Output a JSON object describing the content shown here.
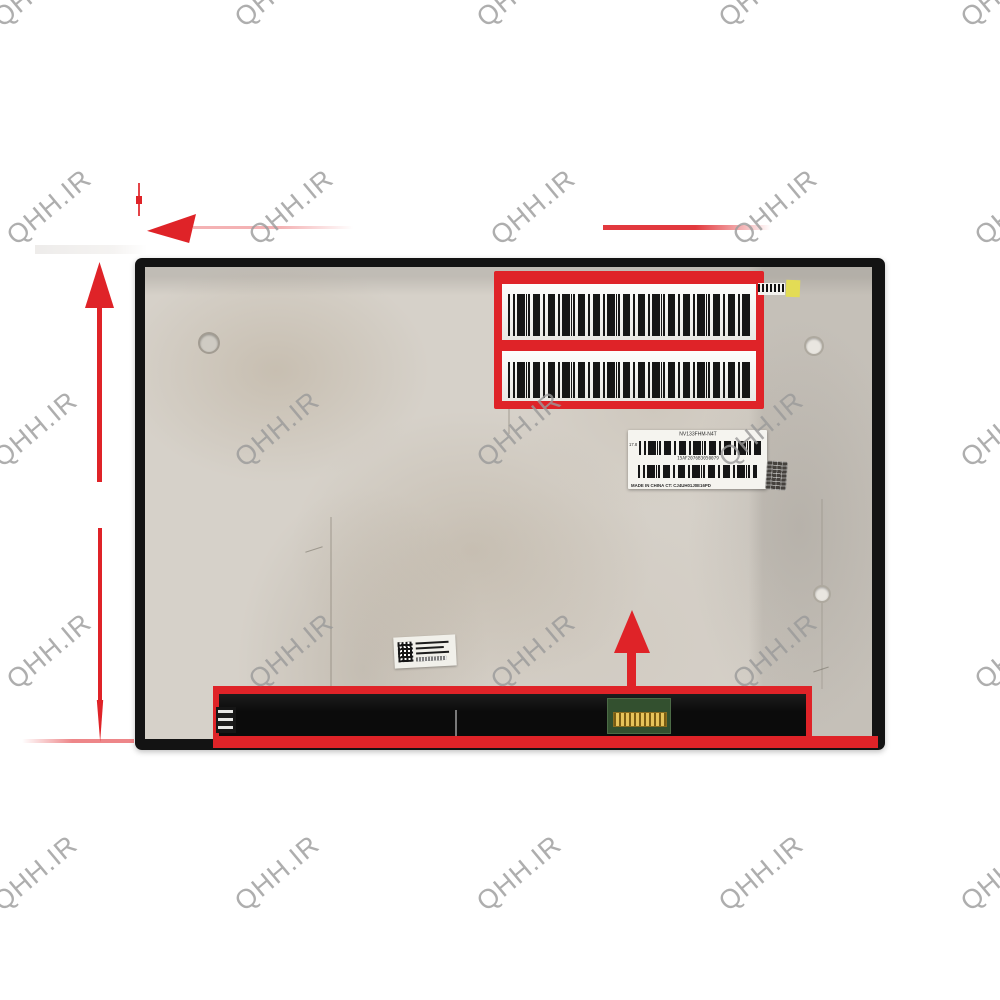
{
  "product_photo": {
    "description": "rear view of laptop LCD screen panel with red measurement arrows and highlighted barcode areas",
    "main_label": {
      "model": "NV133FHM-N4T",
      "size_mark": "17.8",
      "serial": "15AF2076B3050079",
      "origin_line": "MADE IN CHINA  CT: CJ4UH01J0E16PD"
    }
  },
  "watermark": {
    "text": "QHH.IR"
  },
  "colors": {
    "red": "#df2328",
    "wm": "#9a9a9a",
    "yellow": "#e3dc55",
    "pcb_green": "#33502f",
    "connector_gold": "#d9b144"
  }
}
